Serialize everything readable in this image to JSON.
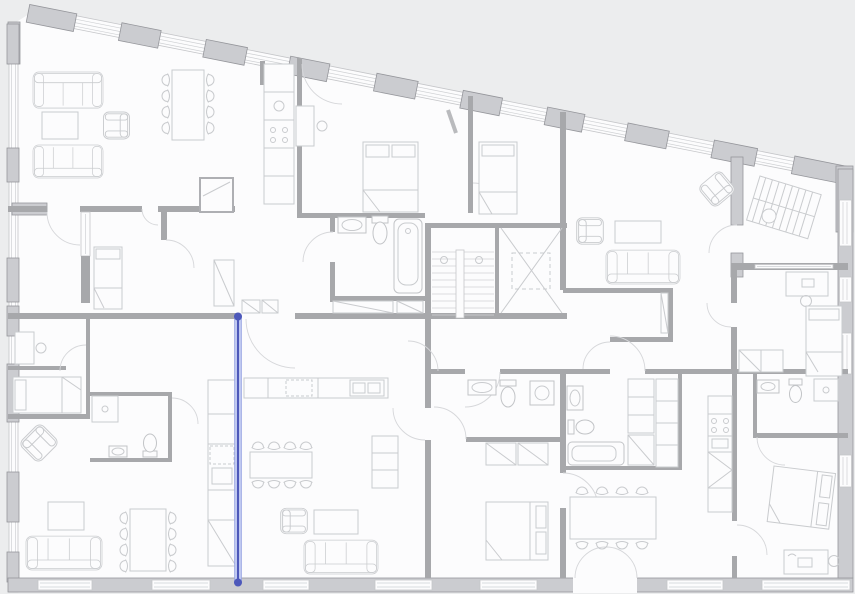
{
  "document": {
    "type": "architectural-floor-plan",
    "view": "top-down",
    "canvas": {
      "width": 855,
      "height": 594
    },
    "visible_text": [],
    "shape": "irregular quadrilateral building, top edge slopes down from left to right"
  },
  "palette": {
    "background": "#ecedee",
    "floor": "#fcfcfd",
    "wall_fill": "#cbccd0",
    "wall_stroke": "#95969b",
    "interior_wall": "#a7a8ab",
    "band_stroke": "#c5c6c9",
    "band_line": "#ced0d3",
    "furniture_line": "#c9cbce",
    "fixture_line": "#c2c4c7",
    "door_line": "#d6d7da",
    "tread_line": "#d2d3d6",
    "highlight_color": "#4d58ba",
    "highlight_fill": "#bfc8f0",
    "highlight_edge": "#8d9ade"
  },
  "highlight": {
    "name": "selected-wall-measure-line",
    "stroke": "#4d58ba",
    "fill": "#bfc8f0",
    "x": 238,
    "y_start": 316.5,
    "y_end": 582.5,
    "endpoint_radius": 4,
    "endpoints": 2
  },
  "inventory": {
    "circulation": [
      "staircase",
      "elevator",
      "corridor"
    ],
    "rooms": [
      "living-room",
      "kitchen",
      "bedroom",
      "bathroom",
      "wc",
      "walk-in-closet",
      "hall"
    ],
    "furniture_symbols": {
      "sofas": 5,
      "armchairs": 5,
      "beds": 7,
      "dining_tables": 4,
      "coffee_tables": 4,
      "desks": 4,
      "dining_chairs": 24,
      "bathtubs": 2,
      "showers": 2,
      "toilets": 5,
      "sinks": 6,
      "wardrobes_closets": 9,
      "kitchen_unit_runs": 4,
      "washing_machine": 1,
      "lounger": 1,
      "round_table": 1
    },
    "openings": {
      "exterior_window_bands": 4,
      "door_swings": 20,
      "french_double_door": 1
    }
  }
}
